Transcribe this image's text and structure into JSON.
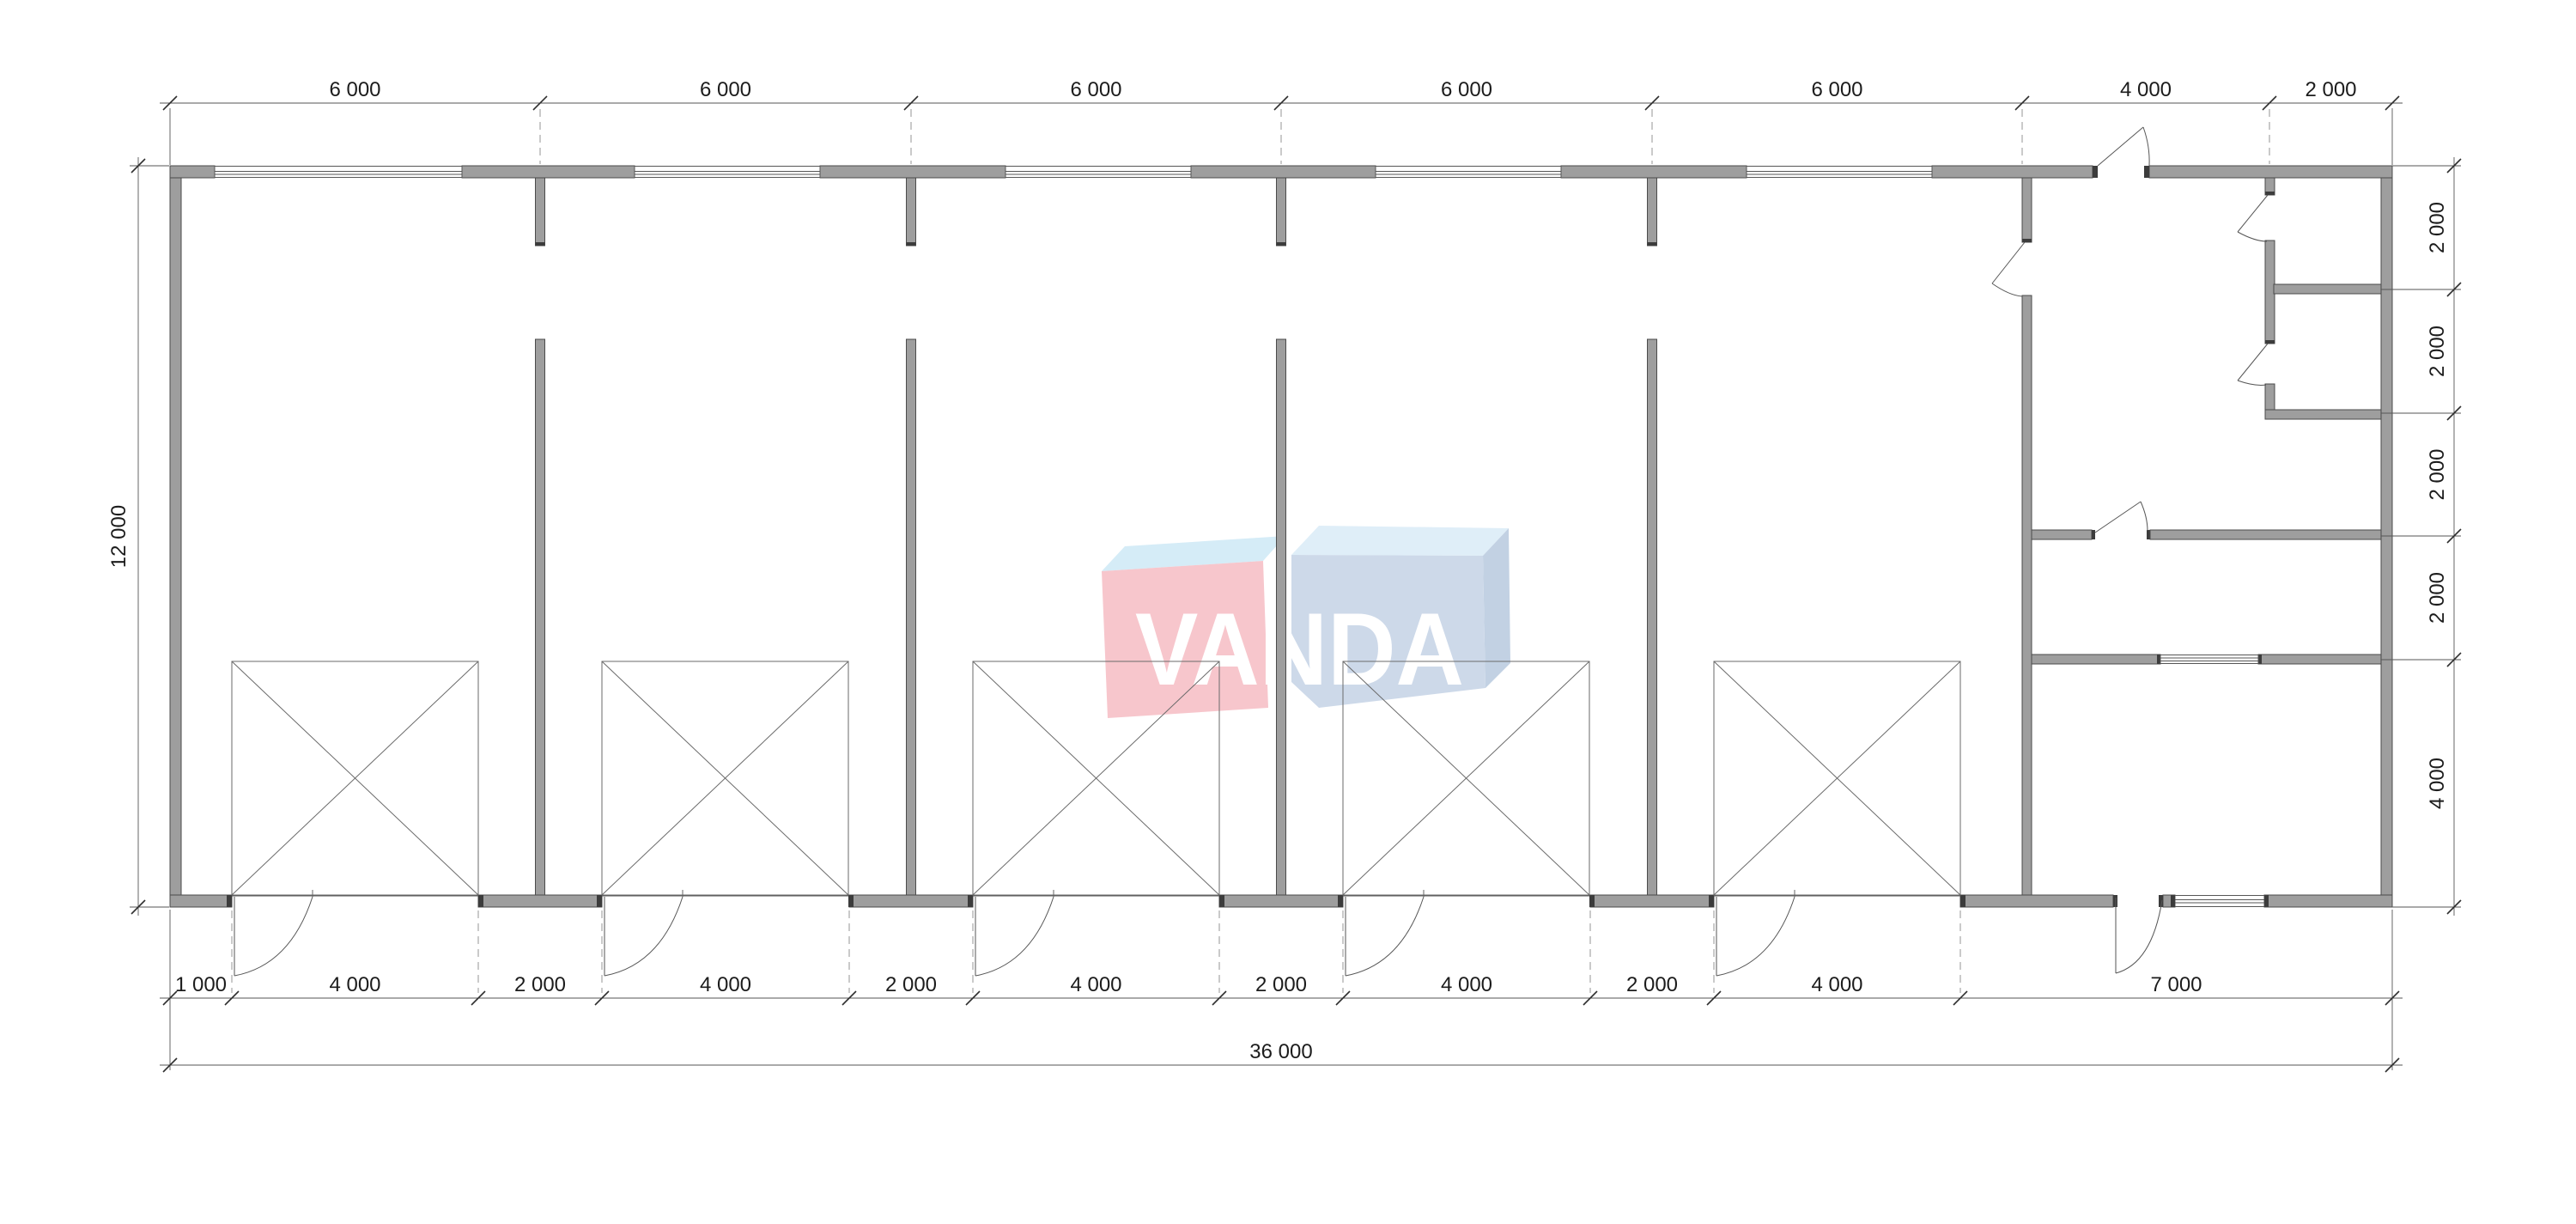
{
  "logo": {
    "text": "VANDA",
    "colors": {
      "pink_face": "#f7c6cc",
      "pink_top": "#d5ecf7",
      "blue_face": "#cdd9e9",
      "blue_top": "#dfeef8",
      "blue_side": "#c2d1e3",
      "letters": "#ffffff"
    }
  },
  "colors": {
    "background": "#ffffff",
    "wall_fill": "#9e9e9e",
    "wall_stroke": "#4b4b4b",
    "line": "#565656",
    "dashed_line": "#8a8a8a",
    "text": "#1c1c1c"
  },
  "dimensions": {
    "top": [
      "6 000",
      "6 000",
      "6 000",
      "6 000",
      "6 000",
      "4 000",
      "2 000"
    ],
    "right": [
      "2 000",
      "2 000",
      "2 000",
      "2 000",
      "4 000"
    ],
    "bottom": [
      "1 000",
      "4 000",
      "2 000",
      "4 000",
      "2 000",
      "4 000",
      "2 000",
      "4 000",
      "2 000",
      "4 000",
      "7 000"
    ],
    "bottom_total": "36 000",
    "left": [
      "12 000"
    ]
  }
}
